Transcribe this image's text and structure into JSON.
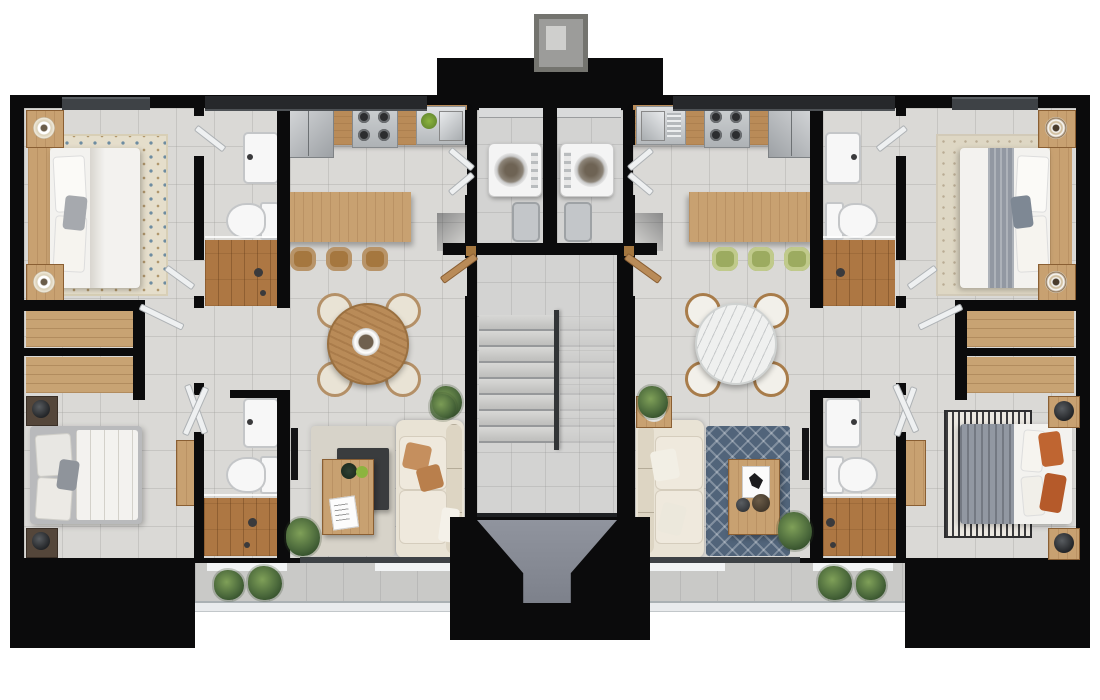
{
  "meta": {
    "type": "architectural-floor-plan-render",
    "description_visible_text": "",
    "units": [
      {
        "id": "apartment-left",
        "rooms": [
          "bedroom-top",
          "bathroom-top",
          "kitchen",
          "dining-area",
          "living-room",
          "bedroom-bottom",
          "bathroom-bottom",
          "laundry-closet",
          "wardrobe-niche",
          "terrace"
        ],
        "furniture": [
          "double-bed",
          "nightstands",
          "lamps",
          "patterned-rug",
          "tv",
          "sink",
          "toilet",
          "walk-in-shower",
          "fridge",
          "cooktop",
          "kitchen-sink",
          "island-counter",
          "bar-stools-wood",
          "round-wood-dining-table",
          "cream-dining-chairs",
          "cream-sofa",
          "coffee-table",
          "dark-tray",
          "washer",
          "laundry-basket",
          "wardrobes",
          "plants"
        ]
      },
      {
        "id": "apartment-right",
        "rooms": [
          "bedroom-top",
          "bathroom-top",
          "kitchen",
          "dining-area",
          "living-room",
          "bedroom-bottom",
          "bathroom-bottom",
          "laundry-closet",
          "wardrobe-niche",
          "terrace"
        ],
        "furniture": [
          "double-bed-gray-runner",
          "nightstands",
          "target-lamps",
          "rug",
          "tv",
          "sink",
          "toilet",
          "walk-in-shower",
          "fridge",
          "cooktop",
          "kitchen-sink",
          "island-counter",
          "bar-stools-green",
          "round-marble-dining-table",
          "wood-dining-chairs",
          "cream-sofa",
          "coffee-table",
          "speaker-side-table",
          "blue-diamond-rug",
          "striped-rug",
          "orange-pillows",
          "washer",
          "laundry-basket",
          "wardrobes",
          "plants"
        ]
      }
    ],
    "shared": [
      "central-staircase",
      "stair-railing",
      "entry-landing",
      "front-walkway",
      "chimney-cap",
      "window-recesses",
      "glass-terrace-railing"
    ]
  },
  "palette": {
    "wall": "#0b0b0c",
    "floor_tile": "#dad9d6",
    "stair_tile": "#d3d3d2",
    "tile_line": "rgba(152,152,150,0.30)",
    "wood_light": "#c8a171",
    "wood_mid": "#b98b58",
    "wood_dark": "#a5773f",
    "oak_floor": "#ad7743",
    "wardrobe": "#c8a373",
    "cream": "#e9e3d5",
    "cream_dark": "#ddd5c3",
    "white_fab": "#f3f2ef",
    "gray_fab": "#a6a9ae",
    "gray_blanket": "#9298a2",
    "rug_cream": "#e5decb",
    "rug_cream2": "#ded7c4",
    "rug_dot": "#6d8ca1",
    "blue_rug": "#51647a",
    "stripe_dark": "#3b3b3d",
    "stripe_light": "#ebe8e1",
    "green_chair": "#9cab60",
    "green_chair_light": "#c0ca8b",
    "orange": "#bf6531",
    "stainless_a": "#d8dadc",
    "stainless_b": "#9da1a5",
    "marble": "#eff0ef",
    "porcelain": "#f7f7f7",
    "walkway_a": "#90949e",
    "walkway_b": "#7d818b",
    "terrace": "#c9c9c7",
    "window_gray": "#3e4246",
    "window_dark": "#26282b",
    "glass": "#eef0f1",
    "plant_a": "#7fa058",
    "plant_b": "#2f4a28",
    "pot": "#8a6a4a",
    "tv": "#141416",
    "tray": "#3a3c3e",
    "dark_wood": "#54463a",
    "threshold": "#e9ebed"
  }
}
